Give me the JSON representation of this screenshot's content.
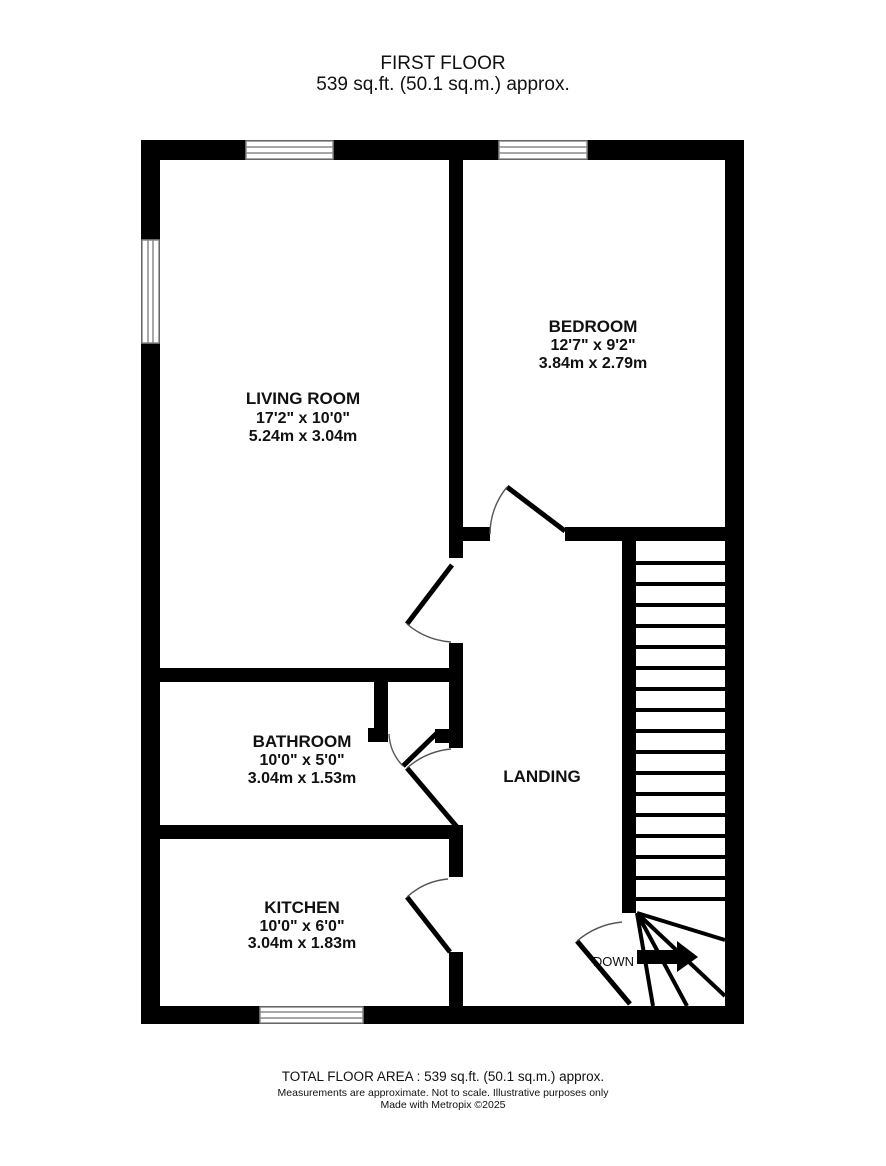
{
  "title": {
    "line1": "FIRST FLOOR",
    "line2": "539 sq.ft. (50.1 sq.m.) approx."
  },
  "rooms": [
    {
      "name": "LIVING ROOM",
      "imperial": "17'2\"  x 10'0\"",
      "metric": "5.24m  x 3.04m"
    },
    {
      "name": "BEDROOM",
      "imperial": "12'7\"  x 9'2\"",
      "metric": "3.84m  x 2.79m"
    },
    {
      "name": "BATHROOM",
      "imperial": "10'0\"  x 5'0\"",
      "metric": "3.04m  x 1.53m"
    },
    {
      "name": "KITCHEN",
      "imperial": "10'0\"  x 6'0\"",
      "metric": "3.04m  x 1.83m"
    },
    {
      "name": "LANDING"
    }
  ],
  "stairs": {
    "label": "DOWN",
    "arrow_icon": "right-arrow"
  },
  "footer": {
    "line1": "TOTAL FLOOR AREA : 539 sq.ft. (50.1 sq.m.) approx.",
    "line2": "Measurements are approximate.  Not to scale.  Illustrative purposes only",
    "line3": "Made with Metropix ©2025"
  },
  "colors": {
    "wall": "#000000",
    "window_line": "#8a8a8a",
    "door_arc": "#555555",
    "text": "#111111",
    "background": "#ffffff"
  }
}
